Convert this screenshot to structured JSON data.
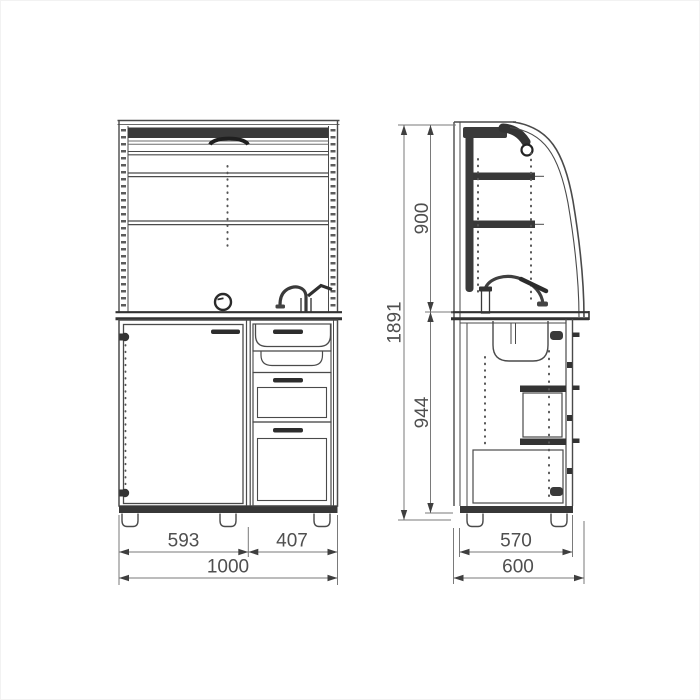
{
  "drawing": {
    "description": "orthographic-cabinet-drawing",
    "colors": {
      "line": "#4a4a4a",
      "dark_fill": "#383838",
      "dimension_line": "#7a7a7a",
      "dimension_text": "#4f4f4f",
      "background": "#ffffff"
    },
    "dimensions": {
      "front": {
        "door_width": "593",
        "drawers_width": "407",
        "total_width": "1000"
      },
      "side": {
        "body_depth": "570",
        "total_depth": "600",
        "upper_height": "900",
        "lower_height": "944",
        "total_height": "1891"
      }
    }
  }
}
